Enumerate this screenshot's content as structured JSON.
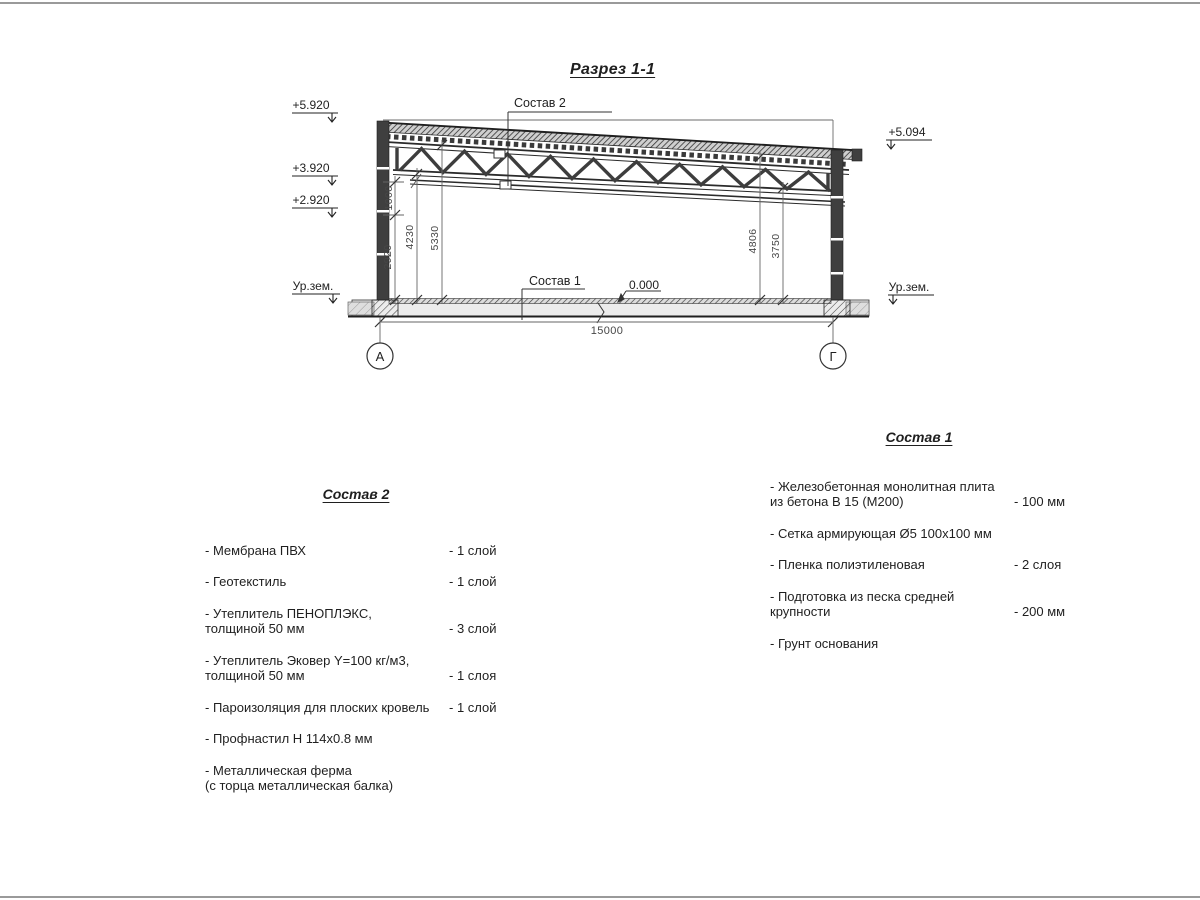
{
  "page": {
    "title": "Разрез 1-1"
  },
  "drawing": {
    "elevations": {
      "e_top_left": "+5.920",
      "e_truss_left": "+3.920",
      "e_wall_left": "+2.920",
      "e_top_right": "+5.094",
      "ground": "Ур.зем.",
      "zero": "0.000"
    },
    "dimensions": {
      "v2920": "2920",
      "v1000": "1000",
      "v4230": "4230",
      "v5330": "5330",
      "v4806": "4806",
      "v3750": "3750",
      "span": "15000"
    },
    "axes": {
      "left": "А",
      "right": "Г"
    },
    "leaders": {
      "roof": "Состав 2",
      "floor": "Состав 1"
    }
  },
  "sostav2": {
    "title": "Состав 2",
    "items": [
      {
        "l1": "- Мембрана ПВХ",
        "l2": "",
        "value": "- 1 слой"
      },
      {
        "l1": "- Геотекстиль",
        "l2": "",
        "value": "- 1 слой"
      },
      {
        "l1": "- Утеплитель ПЕНОПЛЭКС,",
        "l2": "толщиной 50 мм",
        "value": "- 3 слой"
      },
      {
        "l1": "- Утеплитель Эковер Y=100 кг/м3,",
        "l2": "толщиной 50 мм",
        "value": "- 1 слоя"
      },
      {
        "l1": "- Пароизоляция для плоских кровель",
        "l2": "",
        "value": "- 1 слой"
      },
      {
        "l1": "- Профнастил Н 114х0.8 мм",
        "l2": "",
        "value": ""
      },
      {
        "l1": "- Металлическая ферма",
        "l2": "(с торца металлическая балка)",
        "value": ""
      }
    ]
  },
  "sostav1": {
    "title": "Состав 1",
    "items": [
      {
        "l1": "- Железобетонная  монолитная плита",
        "l2": "из бетона В 15 (М200)",
        "value": "- 100 мм"
      },
      {
        "l1": "- Сетка армирующая Ø5 100х100 мм",
        "l2": "",
        "value": ""
      },
      {
        "l1": "- Пленка полиэтиленовая",
        "l2": "",
        "value": "-  2 слоя"
      },
      {
        "l1": "- Подготовка из песка средней",
        "l2": "крупности",
        "value": "- 200 мм"
      },
      {
        "l1": "- Грунт основания",
        "l2": "",
        "value": ""
      }
    ]
  }
}
